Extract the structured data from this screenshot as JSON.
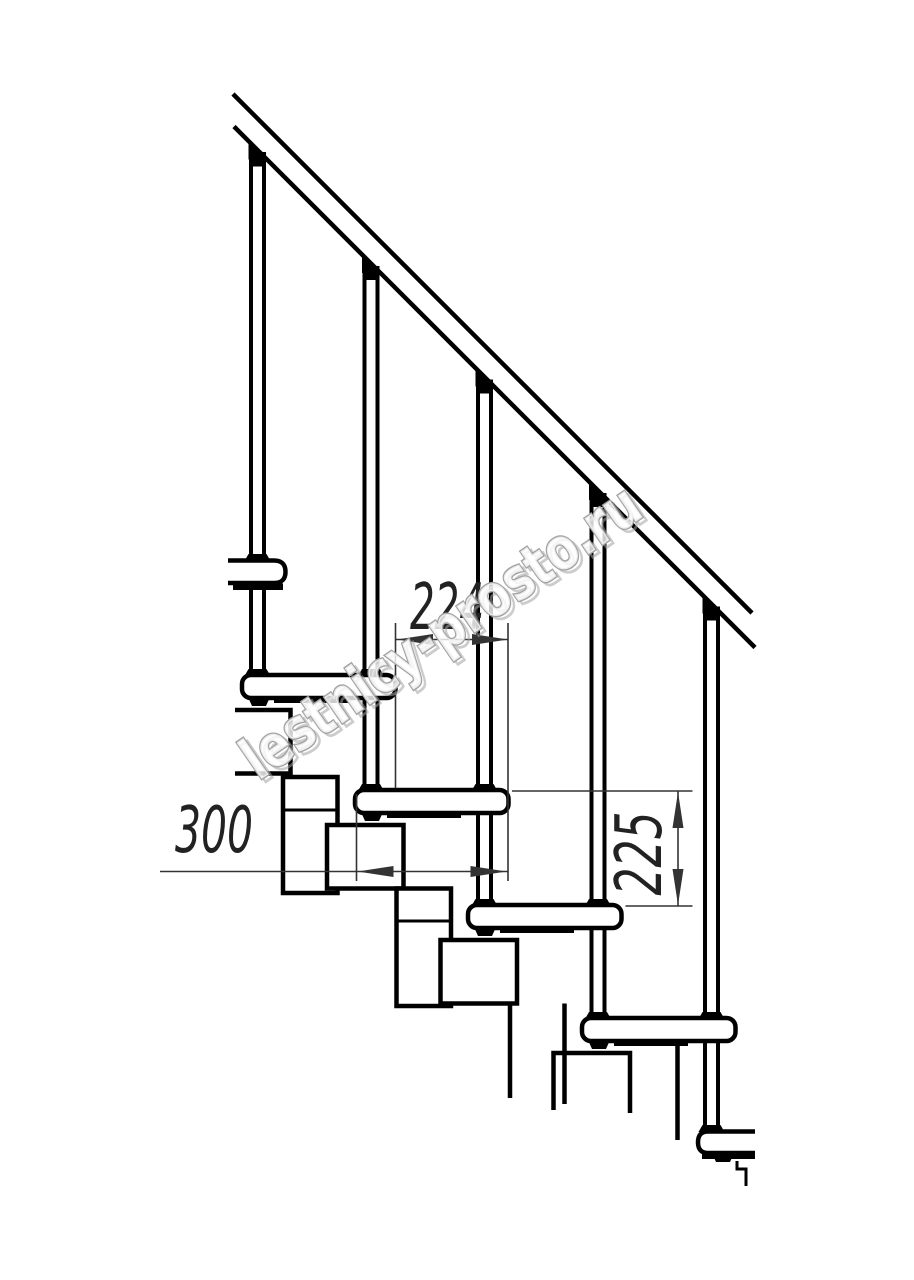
{
  "drawing": {
    "type": "modular-staircase-side-elevation",
    "dimensions": {
      "step_run": "224",
      "tread_depth": "300",
      "riser_height": "225"
    },
    "watermark": {
      "text": "lestnicy-prosto.ru"
    },
    "colors": {
      "line": "#000000",
      "dimension": "#333333",
      "text": "#222222",
      "watermark_outline": "#a3a3a3",
      "background": "#ffffff"
    }
  }
}
